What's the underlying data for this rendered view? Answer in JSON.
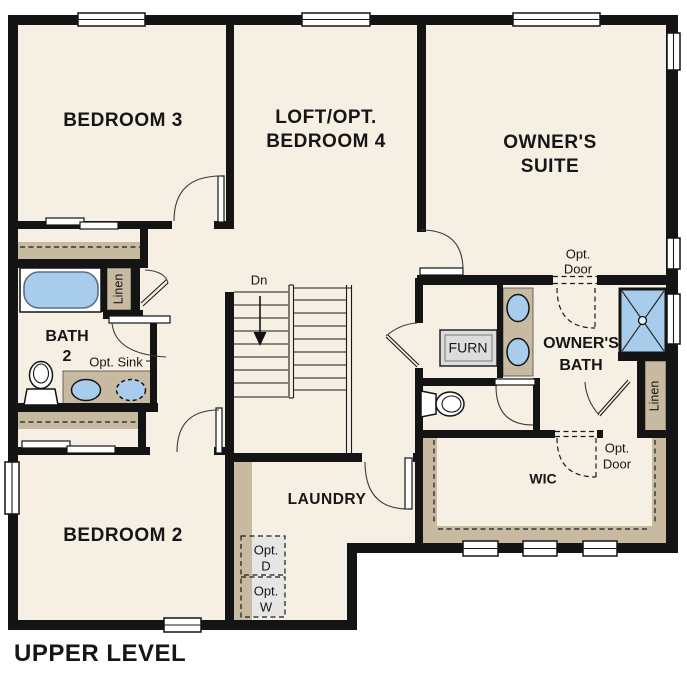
{
  "plan_title": "UPPER LEVEL",
  "colors": {
    "wall": "#141414",
    "floor": "#f6efe3",
    "casework_tan": "#c8baa0",
    "fixture_blue": "#a8cdec",
    "appliance_gray": "#dcdcdc",
    "optional_gray": "#e6e6e6",
    "background": "#ffffff",
    "text": "#161616"
  },
  "rooms": {
    "bedroom3": "BEDROOM 3",
    "loft_line1": "LOFT/OPT.",
    "loft_line2": "BEDROOM 4",
    "owners_suite_line1": "OWNER'S",
    "owners_suite_line2": "SUITE",
    "bath2_line1": "BATH",
    "bath2_line2": "2",
    "bedroom2": "BEDROOM 2",
    "laundry": "LAUNDRY",
    "owners_bath_line1": "OWNER'S",
    "owners_bath_line2": "BATH",
    "wic": "WIC"
  },
  "annotations": {
    "opt_sink": "Opt. Sink",
    "linen_left": "Linen",
    "linen_right": "Linen",
    "stairs_down": "Dn",
    "furnace": "FURN",
    "opt_door_suite_line1": "Opt.",
    "opt_door_suite_line2": "Door",
    "opt_door_wic_line1": "Opt.",
    "opt_door_wic_line2": "Door",
    "opt_dryer_line1": "Opt.",
    "opt_dryer_line2": "D",
    "opt_washer_line1": "Opt.",
    "opt_washer_line2": "W"
  }
}
